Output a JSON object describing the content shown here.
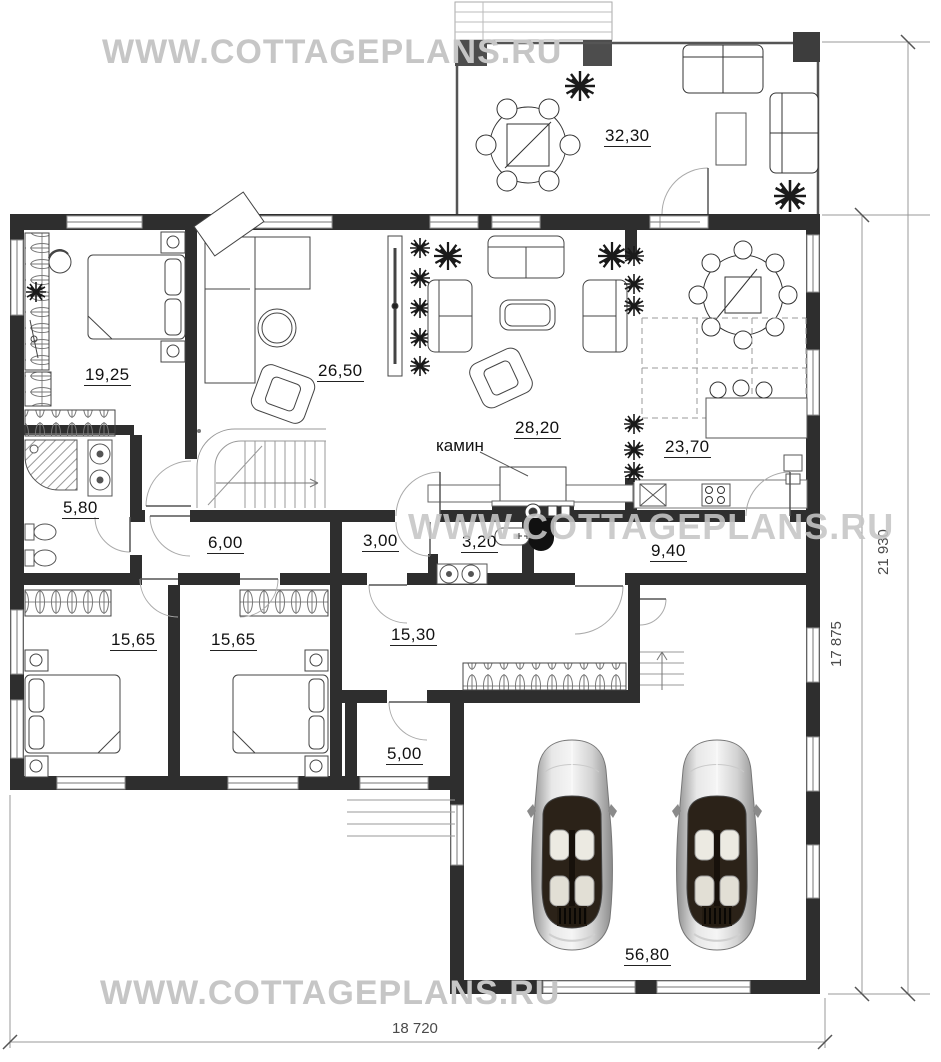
{
  "watermark": {
    "text": "WWW.COTTAGEPLANS.RU"
  },
  "rooms": [
    {
      "name": "terrace",
      "area": "32,30"
    },
    {
      "name": "bedroom-1",
      "area": "19,25"
    },
    {
      "name": "living-room",
      "area": "26,50"
    },
    {
      "name": "family-room",
      "area": "28,20"
    },
    {
      "name": "kitchen-dining",
      "area": "23,70"
    },
    {
      "name": "bathroom",
      "area": "5,80"
    },
    {
      "name": "corridor",
      "area": "6,00"
    },
    {
      "name": "hallway",
      "area": "3,00"
    },
    {
      "name": "wc",
      "area": "3,20"
    },
    {
      "name": "passage",
      "area": "9,40"
    },
    {
      "name": "bedroom-2",
      "area": "15,65"
    },
    {
      "name": "bedroom-3",
      "area": "15,65"
    },
    {
      "name": "entrance-hall",
      "area": "15,30"
    },
    {
      "name": "porch",
      "area": "5,00"
    },
    {
      "name": "garage",
      "area": "56,80"
    }
  ],
  "annotations": {
    "fireplace": "камин"
  },
  "dimensions": {
    "total_height": "21 930",
    "house_height": "17 875",
    "total_width": "18 720"
  },
  "colors": {
    "wall": "#2e2e2e",
    "watermark": "#c6c6c6",
    "dimension_text": "#4a4a4a",
    "thin_line": "#999999"
  }
}
